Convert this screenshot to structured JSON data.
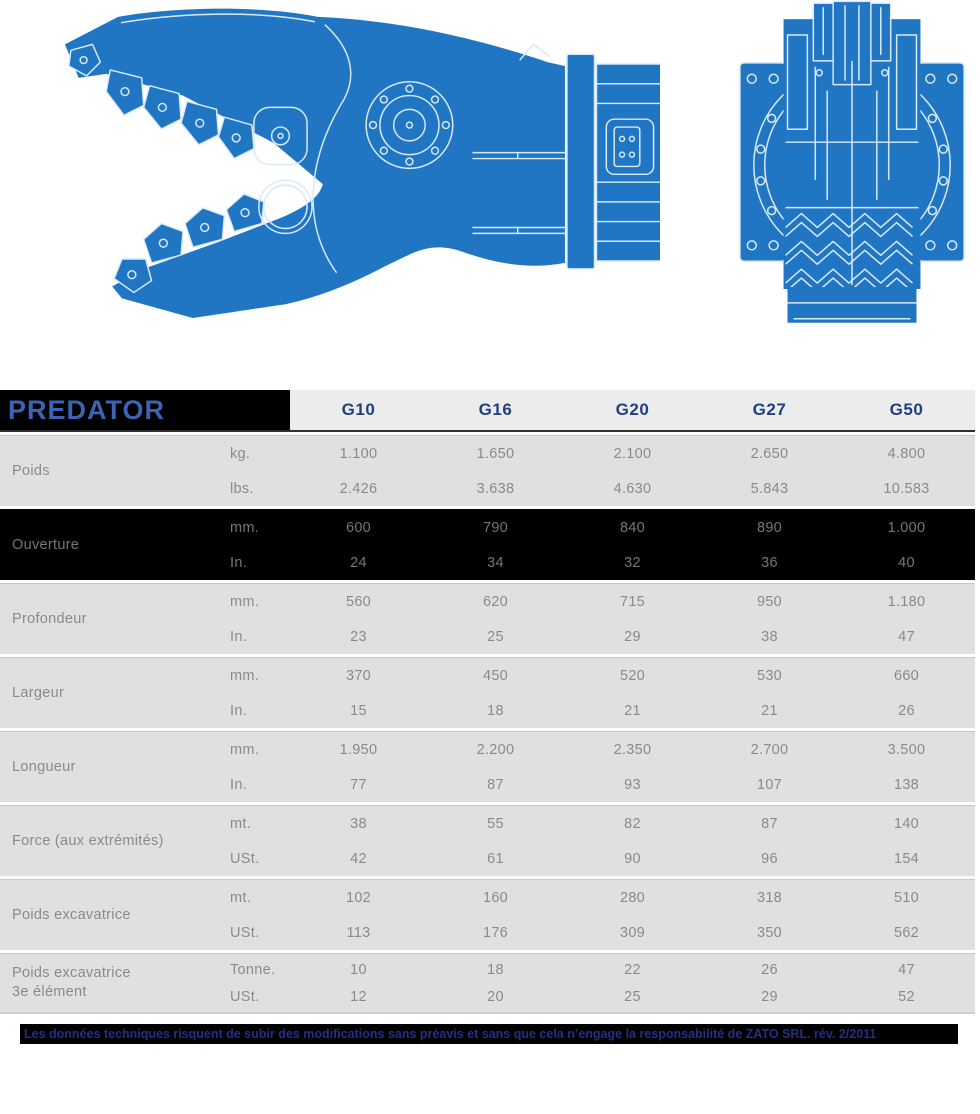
{
  "table": {
    "title": "PREDATOR",
    "columns": [
      "G10",
      "G16",
      "G20",
      "G27",
      "G50"
    ],
    "groups": [
      {
        "label": "Poids",
        "highlight": false,
        "rows": [
          {
            "unit": "kg.",
            "values": [
              "1.100",
              "1.650",
              "2.100",
              "2.650",
              "4.800"
            ]
          },
          {
            "unit": "lbs.",
            "values": [
              "2.426",
              "3.638",
              "4.630",
              "5.843",
              "10.583"
            ]
          }
        ]
      },
      {
        "label": "Ouverture",
        "highlight": true,
        "rows": [
          {
            "unit": "mm.",
            "values": [
              "600",
              "790",
              "840",
              "890",
              "1.000"
            ]
          },
          {
            "unit": "In.",
            "values": [
              "24",
              "34",
              "32",
              "36",
              "40"
            ]
          }
        ]
      },
      {
        "label": "Profondeur",
        "highlight": false,
        "rows": [
          {
            "unit": "mm.",
            "values": [
              "560",
              "620",
              "715",
              "950",
              "1.180"
            ]
          },
          {
            "unit": "In.",
            "values": [
              "23",
              "25",
              "29",
              "38",
              "47"
            ]
          }
        ]
      },
      {
        "label": "Largeur",
        "highlight": false,
        "rows": [
          {
            "unit": "mm.",
            "values": [
              "370",
              "450",
              "520",
              "530",
              "660"
            ]
          },
          {
            "unit": "In.",
            "values": [
              "15",
              "18",
              "21",
              "21",
              "26"
            ]
          }
        ]
      },
      {
        "label": "Longueur",
        "highlight": false,
        "rows": [
          {
            "unit": "mm.",
            "values": [
              "1.950",
              "2.200",
              "2.350",
              "2.700",
              "3.500"
            ]
          },
          {
            "unit": "In.",
            "values": [
              "77",
              "87",
              "93",
              "107",
              "138"
            ]
          }
        ]
      },
      {
        "label": "Force (aux extrémités)",
        "highlight": false,
        "rows": [
          {
            "unit": "mt.",
            "values": [
              "38",
              "55",
              "82",
              "87",
              "140"
            ]
          },
          {
            "unit": "USt.",
            "values": [
              "42",
              "61",
              "90",
              "96",
              "154"
            ]
          }
        ]
      },
      {
        "label": "Poids excavatrice",
        "highlight": false,
        "rows": [
          {
            "unit": "mt.",
            "values": [
              "102",
              "160",
              "280",
              "318",
              "510"
            ]
          },
          {
            "unit": "USt.",
            "values": [
              "113",
              "176",
              "309",
              "350",
              "562"
            ]
          }
        ]
      },
      {
        "label": "Poids excavatrice",
        "label2": "3e élément",
        "highlight": false,
        "rows": [
          {
            "unit": "Tonne.",
            "values": [
              "10",
              "18",
              "22",
              "26",
              "47"
            ]
          },
          {
            "unit": "USt.",
            "values": [
              "12",
              "20",
              "25",
              "29",
              "52"
            ]
          }
        ]
      }
    ]
  },
  "footer": {
    "note": "Les données techniques risquent de subir des modifications sans préavis et sans que cela n’engage la responsabilité de ZATO SRL. rév. 2/2011"
  },
  "colors": {
    "title_blue": "#3c64b4",
    "header_blue": "#20417f",
    "header_bg": "#ececec",
    "row_bg": "#e0e0e0",
    "dark_bg": "#000000",
    "text_gray": "#8a8a8a",
    "dark_text": "#767676",
    "note_blue": "#262f86",
    "blueprint_blue": "#2176c4",
    "blueprint_line": "#d7eafb"
  }
}
